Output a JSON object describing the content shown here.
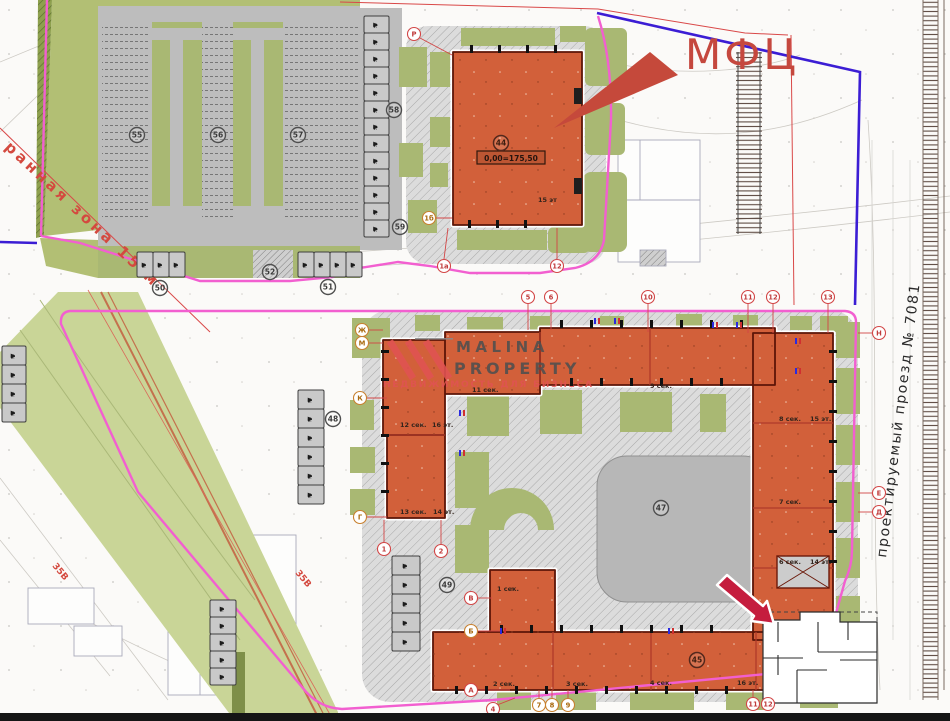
{
  "callout": {
    "mfc_label": "МФЦ"
  },
  "watermark": {
    "brand_top": "MALINA",
    "brand_bottom": "PROPERTY",
    "tagline": "НЕДВИЖИМОСТЬ ДЛЯ БИЗНЕСА"
  },
  "street_label": "проектируемый проезд № 7081",
  "zone_label": "ранная зона 15 м",
  "power_label_1": "35В",
  "power_label_2": "35В",
  "mfc_building": {
    "number": "44",
    "elevation": "0,00=175,50",
    "floors": "15 эт"
  },
  "sections": {
    "s11": "11 сек.",
    "s12": "12 сек.",
    "s12f": "16 эт.",
    "s13": "13 сек.",
    "s13f": "14 эт.",
    "s9": "9 сек.",
    "s8": "8 сек.",
    "s8f": "15 эт.",
    "s7": "7 сек.",
    "s6": "6 сек.",
    "s6f": "14 эт.",
    "s1": "1 сек.",
    "s2": "2 сек.",
    "s3": "3 сек.",
    "s4": "4 сек.",
    "s4f": "16 эт."
  },
  "site_numbers": {
    "n45": "45",
    "n47": "47",
    "n48": "48",
    "n49": "49",
    "n50": "50",
    "n51": "51",
    "n52": "52",
    "n55": "55",
    "n56": "56",
    "n57": "57",
    "n58": "58",
    "n59": "59"
  },
  "axes": {
    "top": [
      "5",
      "6",
      "10",
      "11",
      "12",
      "13"
    ],
    "left": [
      "Ж",
      "М",
      "К",
      "Г"
    ],
    "bottomleft": [
      "1",
      "2"
    ],
    "west": [
      "В",
      "Б",
      "А",
      "4"
    ],
    "bottom": [
      "7",
      "8",
      "9",
      "11",
      "12"
    ],
    "right": [
      "Н",
      "Е",
      "Д"
    ],
    "mfc": [
      "Р",
      "1а",
      "12",
      "1б"
    ]
  },
  "colors": {
    "building_orange": "#d2603a",
    "boundary_pink": "#f25fd0",
    "line_indigo": "#3b1dd4",
    "callout_red": "#c5483e",
    "arrow_crimson": "#c51d3e",
    "green": "#a9b873"
  }
}
